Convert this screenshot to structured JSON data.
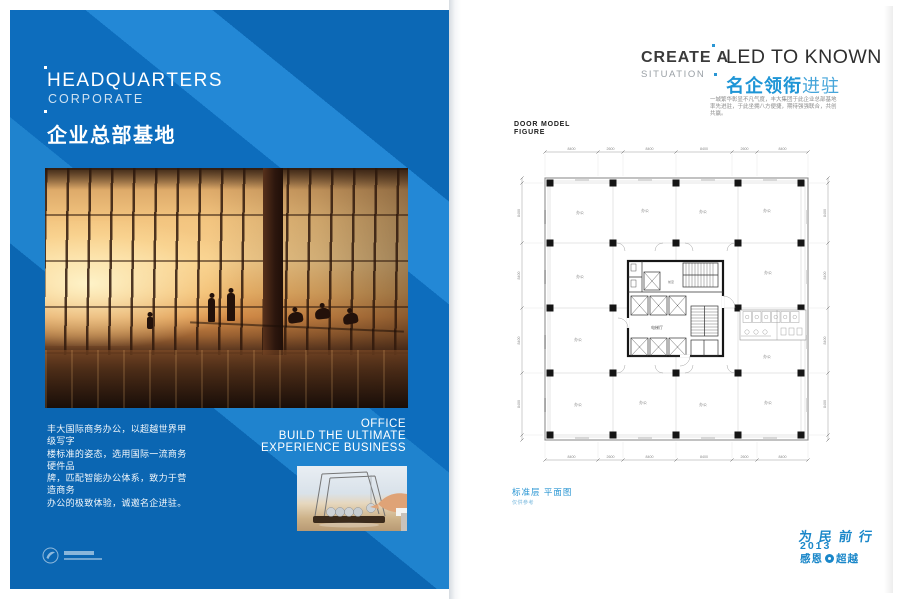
{
  "left_panel": {
    "title_en": "HEADQUARTERS",
    "title_en_sub": "CORPORATE",
    "title_cn": "企业总部基地",
    "body_lines": [
      "丰大国际商务办公，以超越世界甲级写字",
      "楼标准的姿态，选用国际一流商务硬件品",
      "牌，匹配智能办公体系，致力于营造商务",
      "办公的极致体验，诚邀名企进驻。"
    ],
    "office_tagline": [
      "OFFICE",
      "BUILD THE ULTIMATE",
      "EXPERIENCE BUSINESS"
    ]
  },
  "right_page": {
    "create": "CREATE A",
    "situation": "SITUATION",
    "led_to_known": "LED TO KNOWN",
    "headline_cn_bold": "名企领衔",
    "headline_cn_light": "进驻",
    "intro_lines": [
      "一城繁华彰显不凡气度，丰大集团于此企业总部基地",
      "率先进驻，于此坐拥八方便捷，期待强强联合，共创",
      "共赢。"
    ],
    "plan_heading_lines": [
      "DOOR MODEL",
      "FIGURE"
    ],
    "plan_caption": "标准层 平面图",
    "plan_caption_sub": "仅供参考",
    "footer_slogan": "为民前行",
    "footer_year": "2013",
    "footer_thanks_left": "感恩",
    "footer_thanks_right": "超越"
  },
  "plan": {
    "office_label": "办公",
    "hall_label": "电梯厅",
    "lobby_label": "前室",
    "dims_top": [
      "8400",
      "2600",
      "8400",
      "8400",
      "2600",
      "8400"
    ],
    "dims_bottom": [
      "8400",
      "2600",
      "8400",
      "8400",
      "2600",
      "8400"
    ],
    "dims_left": [
      "8400",
      "8400",
      "8400",
      "8400"
    ],
    "dims_right": [
      "8400",
      "8400",
      "8400",
      "8400"
    ]
  },
  "colors": {
    "panel_blue": "#0d6dbd",
    "panel_blue_light": "#2388d6",
    "headline_blue": "#1e95d6",
    "footer_blue": "#1a87c9"
  }
}
